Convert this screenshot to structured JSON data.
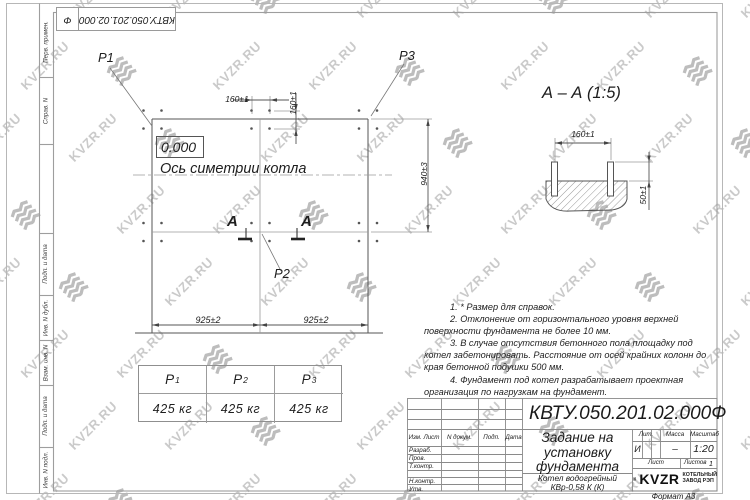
{
  "watermark": {
    "text": "KVZR.RU"
  },
  "sheet": {
    "ref_box": {
      "number": "КВТУ.050.201.02.000",
      "suffix": "Ф"
    },
    "left_strip": [
      "Перв. примен.",
      "Справ. N",
      "Подп. и дата",
      "Инв. N дубл.",
      "Взам. инв. N",
      "Подп. и дата",
      "Инв. N подл."
    ]
  },
  "plan": {
    "p1": "Р1",
    "p2": "Р2",
    "p3": "Р3",
    "level": "0.000",
    "axis": "Ось симетрии котла",
    "section_letter": "А",
    "dim_160_top": "160±1",
    "dim_160_side": "160±1",
    "dim_940": "940±3",
    "dim_925_left": "925±2",
    "dim_925_right": "925±2"
  },
  "section_view": {
    "title": "А – А (1:5)",
    "dim_160": "160±1",
    "dim_50": "50±1"
  },
  "notes": [
    "1. * Размер для справок.",
    "2. Отклонение от горизонтального уровня верхней поверхности фундамента не более 10 мм.",
    "3. В случае отсутствия бетонного пола площадку под котел забетонировать. Расстояние от осей крайних колонн до края бетонной подушки 500 мм.",
    "4. Фундамент под котел разрабатывает проектная организация по нагрузкам на фундамент."
  ],
  "load_table": {
    "headers": [
      {
        "base": "Р",
        "sub": "1"
      },
      {
        "base": "Р",
        "sub": "2"
      },
      {
        "base": "Р",
        "sub": "3"
      }
    ],
    "values": [
      "425 кг",
      "425 кг",
      "425 кг"
    ]
  },
  "title_block": {
    "doc_number": "КВТУ.050.201.02.000",
    "doc_suffix": "Ф",
    "header_cells": [
      "Изм. Лист",
      "N докум.",
      "Подп.",
      "Дата"
    ],
    "side_rows": [
      "Разраб.",
      "Пров.",
      "Т.контр.",
      "Н.контр.",
      "Утв."
    ],
    "title": "Задание на\nустановку\nфундамента",
    "product": "Котел водогрейный\nКВр-0,58 К (К)",
    "lit_label": "Лит.",
    "lit_value": "И",
    "mass_label": "Масса",
    "mass_value": "–",
    "scale_label": "Масштаб",
    "scale_value": "1:20",
    "sheet_label": "Лист",
    "sheets_label": "Листов",
    "sheets_value": "1",
    "brand": "KVZR",
    "brand_sub": "КОТЕЛЬНЫЙ\nЗАВОД РЭП",
    "format": "Формат А3"
  }
}
